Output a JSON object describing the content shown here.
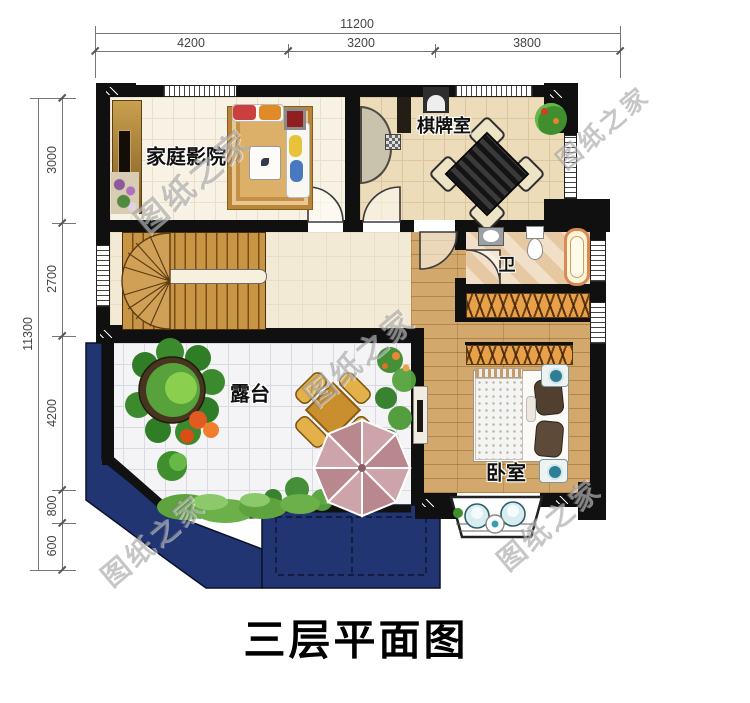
{
  "title": "三层平面图",
  "watermark": {
    "text": "图纸之家"
  },
  "dimensions": {
    "top": {
      "total": "11200",
      "segments": [
        "4200",
        "3200",
        "3800"
      ]
    },
    "left": {
      "total": "11300",
      "segments": [
        "3000",
        "2700",
        "4200",
        "800",
        "600"
      ]
    }
  },
  "rooms": {
    "home_theater": {
      "label": "家庭影院"
    },
    "chess_room": {
      "label": "棋牌室"
    },
    "bathroom": {
      "label": "卫"
    },
    "terrace": {
      "label": "露台"
    },
    "bedroom": {
      "label": "卧室"
    }
  },
  "colors": {
    "wall": "#101010",
    "roof": "#203571",
    "wood_floor": "#d2a86c",
    "stair_wood": "#c79544",
    "terrace_tile": "#f4f4f7",
    "umbrella": "#cda4aa",
    "foliage": "#3f8f2f"
  }
}
